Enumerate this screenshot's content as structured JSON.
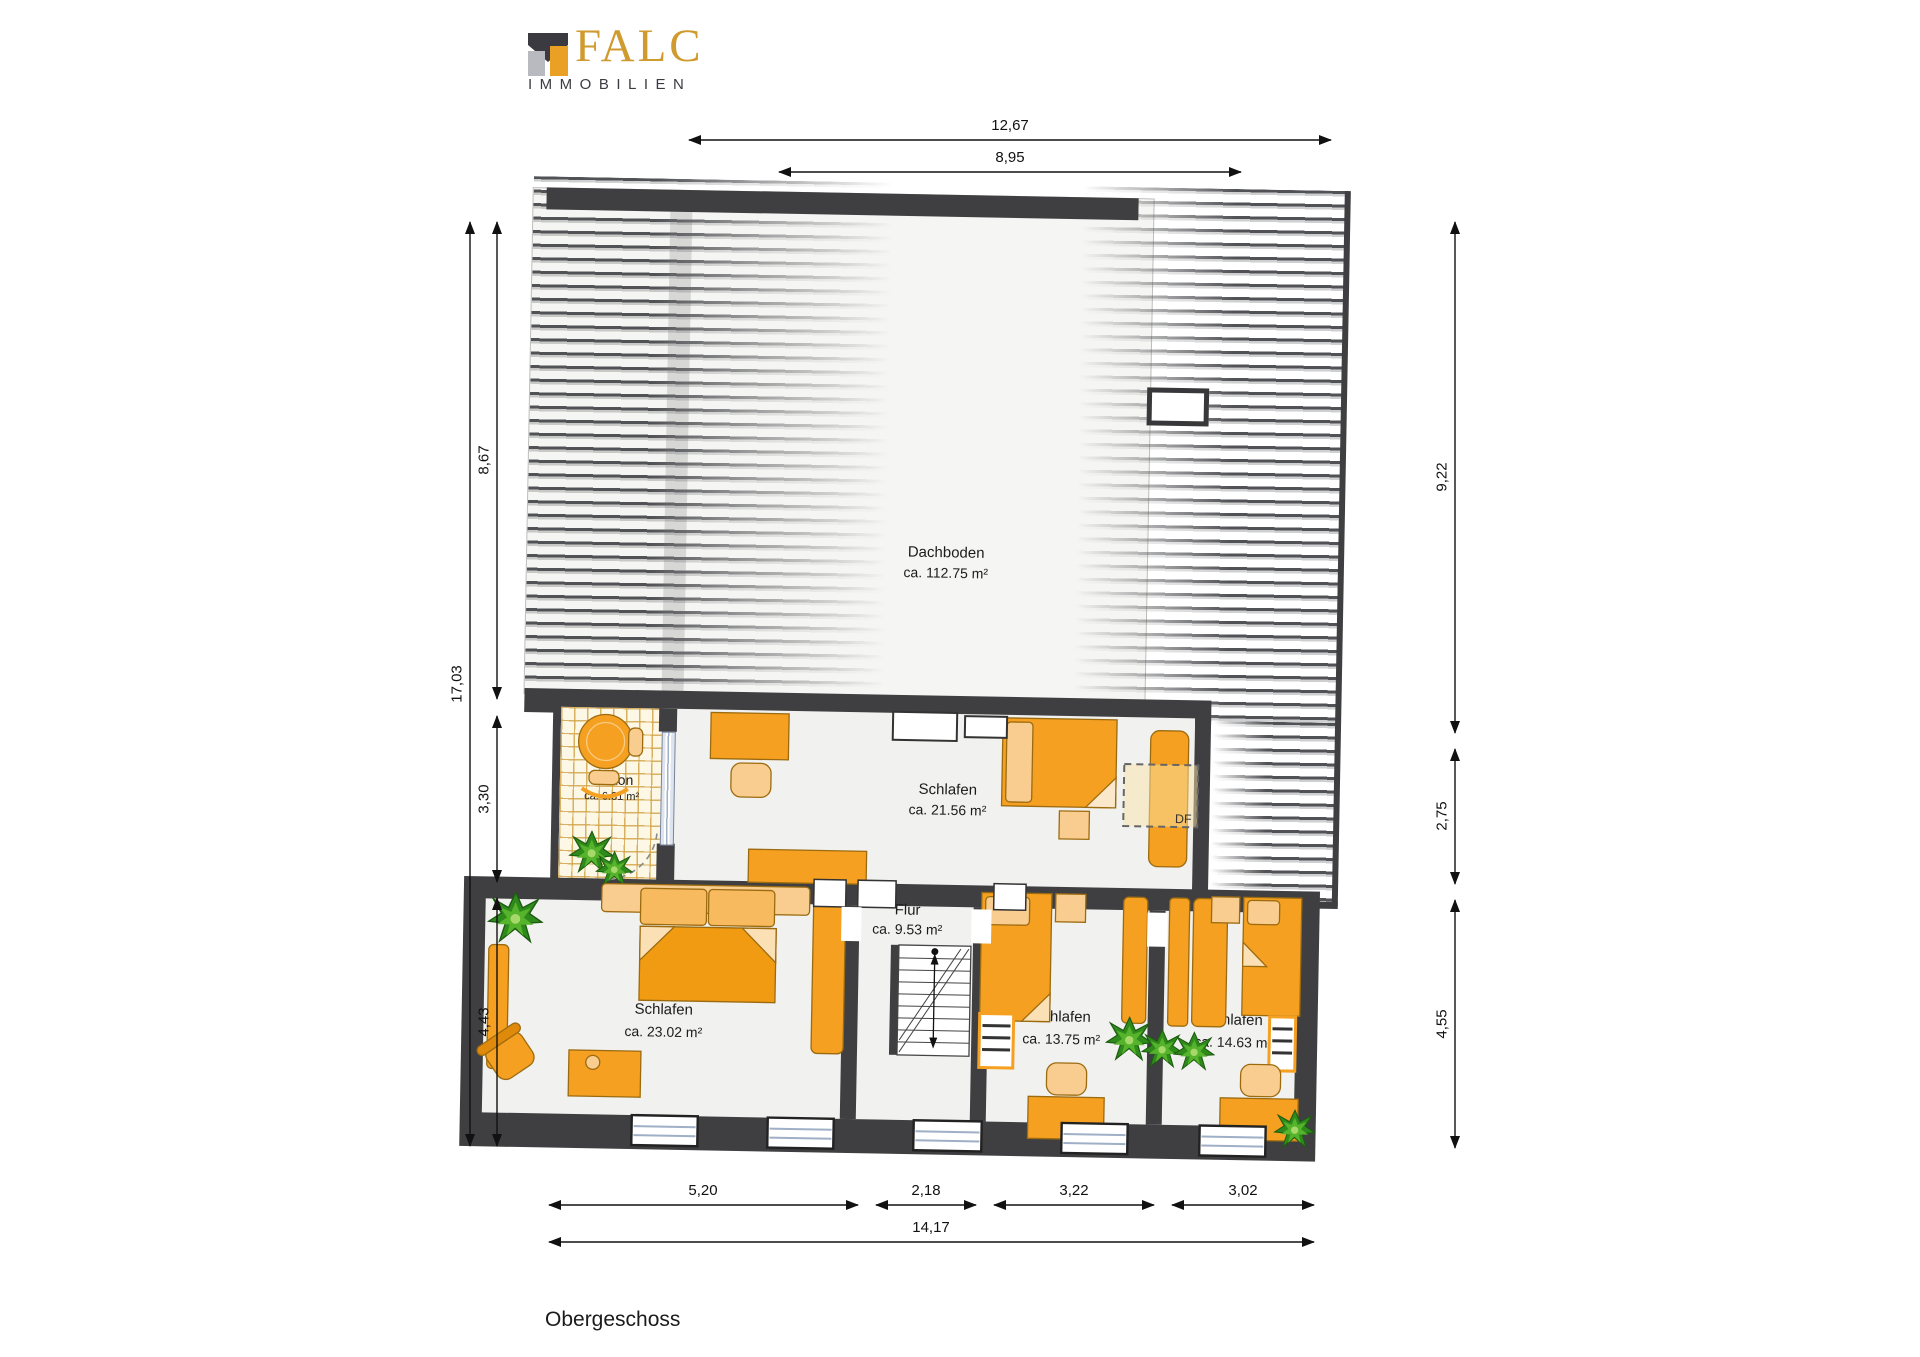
{
  "logo": {
    "brand": "FALC",
    "subtitle": "IMMOBILIEN"
  },
  "floor_title": "Obergeschoss",
  "rooms": {
    "dachboden": {
      "name": "Dachboden",
      "area": "ca. 112.75 m²"
    },
    "balkon": {
      "name": "Balkon",
      "area": "ca. 6.31 m²"
    },
    "schlafen_oben": {
      "name": "Schlafen",
      "area": "ca. 21.56 m²"
    },
    "flur": {
      "name": "Flur",
      "area": "ca. 9.53 m²"
    },
    "schlafen_links": {
      "name": "Schlafen",
      "area": "ca. 23.02 m²"
    },
    "schlafen_mitte": {
      "name": "Schlafen",
      "area": "ca. 13.75 m²"
    },
    "schlafen_rechts": {
      "name": "Schlafen",
      "area": "ca. 14.63 m²"
    }
  },
  "annotations": {
    "roof_window": "DF"
  },
  "dimensions_m": {
    "top": [
      "12,67",
      "8,95"
    ],
    "left": [
      "17,03",
      "8,67",
      "3,30",
      "4,43"
    ],
    "right": [
      "9,22",
      "2,75",
      "4,55"
    ],
    "bottom": [
      "5,20",
      "2,18",
      "3,22",
      "3,02",
      "14,17"
    ]
  },
  "colors": {
    "wall": "#3f3f41",
    "furniture_orange": "#f5a020",
    "furniture_light": "#f8cd8f",
    "plant_green": "#3c9023",
    "logo_gold": "#cf9a2e",
    "glass_blue": "#eef2f7",
    "tile_line": "#d2a54b"
  }
}
